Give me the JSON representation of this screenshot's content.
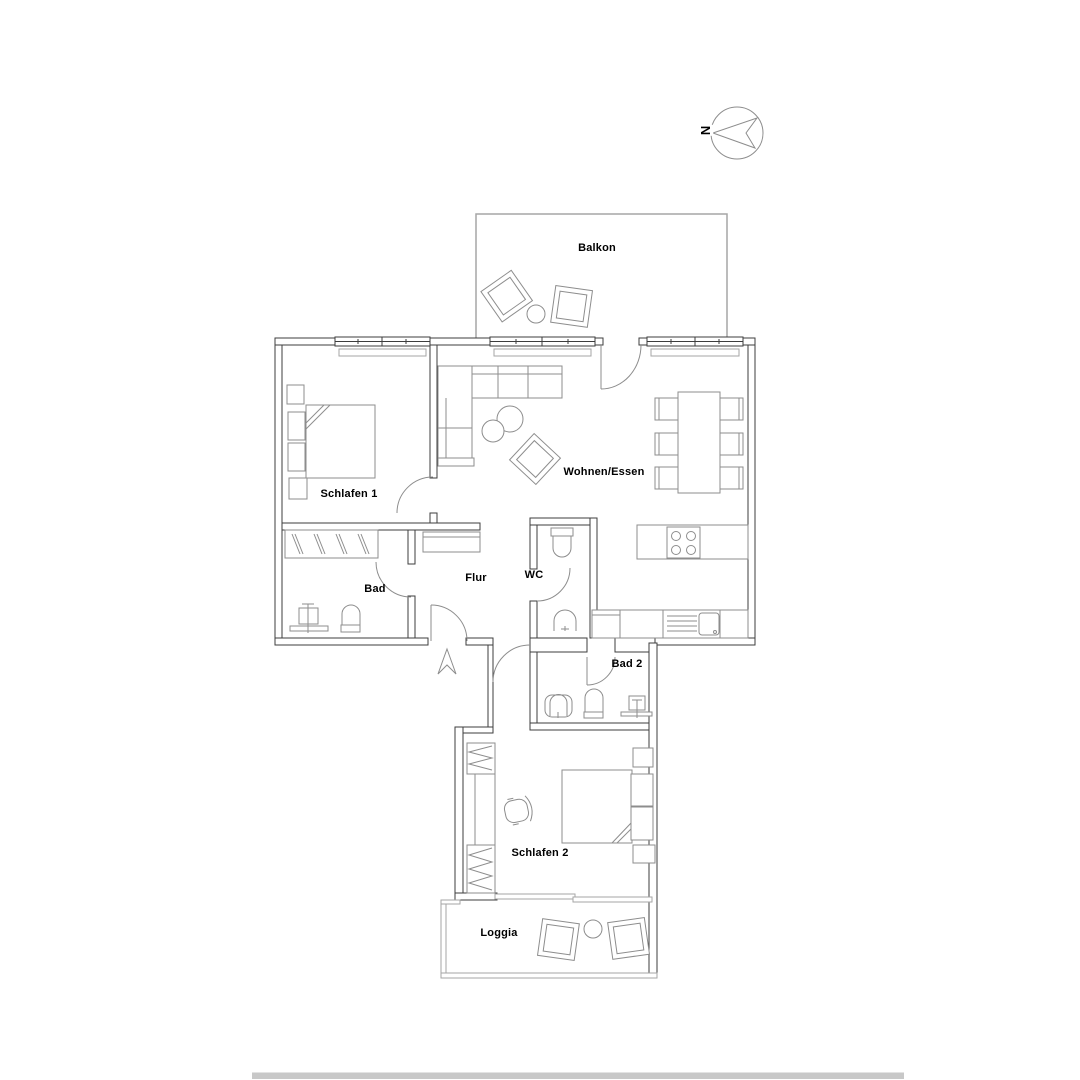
{
  "rooms": {
    "balkon": {
      "label": "Balkon"
    },
    "schlafen1": {
      "label": "Schlafen 1"
    },
    "wohnen_essen": {
      "label": "Wohnen/Essen"
    },
    "bad": {
      "label": "Bad"
    },
    "flur": {
      "label": "Flur"
    },
    "wc": {
      "label": "WC"
    },
    "bad2": {
      "label": "Bad 2"
    },
    "schlafen2": {
      "label": "Schlafen 2"
    },
    "loggia": {
      "label": "Loggia"
    }
  },
  "compass": {
    "north_label": "N"
  },
  "colors": {
    "background": "#ffffff",
    "wall": "#3d3d3d",
    "furniture": "#8d8d8d",
    "thin": "#a6a6a6",
    "scrollbar": "#c8c8c8",
    "text": "#000000"
  }
}
